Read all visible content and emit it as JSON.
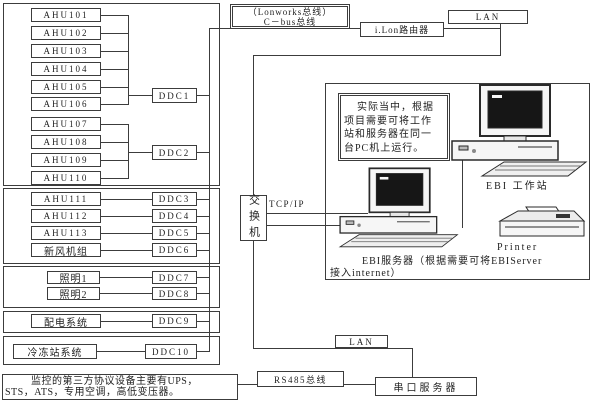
{
  "top": {
    "lonworks_line1": "（Lonworks总线）",
    "lonworks_line2": "C－bus总线",
    "ilon_router": "i.Lon路由器",
    "lan": "LAN"
  },
  "left_column": {
    "ahu_bank1": [
      "AHU101",
      "AHU102",
      "AHU103",
      "AHU104",
      "AHU105",
      "AHU106"
    ],
    "ddc1": "DDC1",
    "ahu_bank2": [
      "AHU107",
      "AHU108",
      "AHU109",
      "AHU110"
    ],
    "ddc2": "DDC2",
    "direct_rows": [
      {
        "device": "AHU111",
        "ddc": "DDC3"
      },
      {
        "device": "AHU112",
        "ddc": "DDC4"
      },
      {
        "device": "AHU113",
        "ddc": "DDC5"
      },
      {
        "device": "新风机组",
        "ddc": "DDC6"
      },
      {
        "device": "照明1",
        "ddc": "DDC7"
      },
      {
        "device": "照明2",
        "ddc": "DDC8"
      },
      {
        "device": "配电系统",
        "ddc": "DDC9"
      },
      {
        "device": "冷冻站系统",
        "ddc": "DDC10"
      }
    ]
  },
  "middle": {
    "switch_label": "交换机",
    "tcpip_label": "TCP/IP"
  },
  "panel": {
    "note_line1": "实际当中，根据",
    "note_line2": "项目需要可将工作",
    "note_line3": "站和服务器在同一",
    "note_line4": "台PC机上运行。",
    "workstation_label": "EBI 工作站",
    "printer_label": "Printer",
    "server_caption_line1": "EBI服务器（根据需要可将EBIServer",
    "server_caption_line2": "接入internet）"
  },
  "bottom": {
    "lan": "LAN",
    "rs485": "RS485总线",
    "serial_server": "串口服务器",
    "third_party_line1": "监控的第三方协议设备主要有UPS，",
    "third_party_line2": "STS，ATS，专用空调，高低变压器。"
  },
  "colors": {
    "line": "#3c3c3c",
    "text": "#1e1e1e",
    "screen": "#161616"
  }
}
